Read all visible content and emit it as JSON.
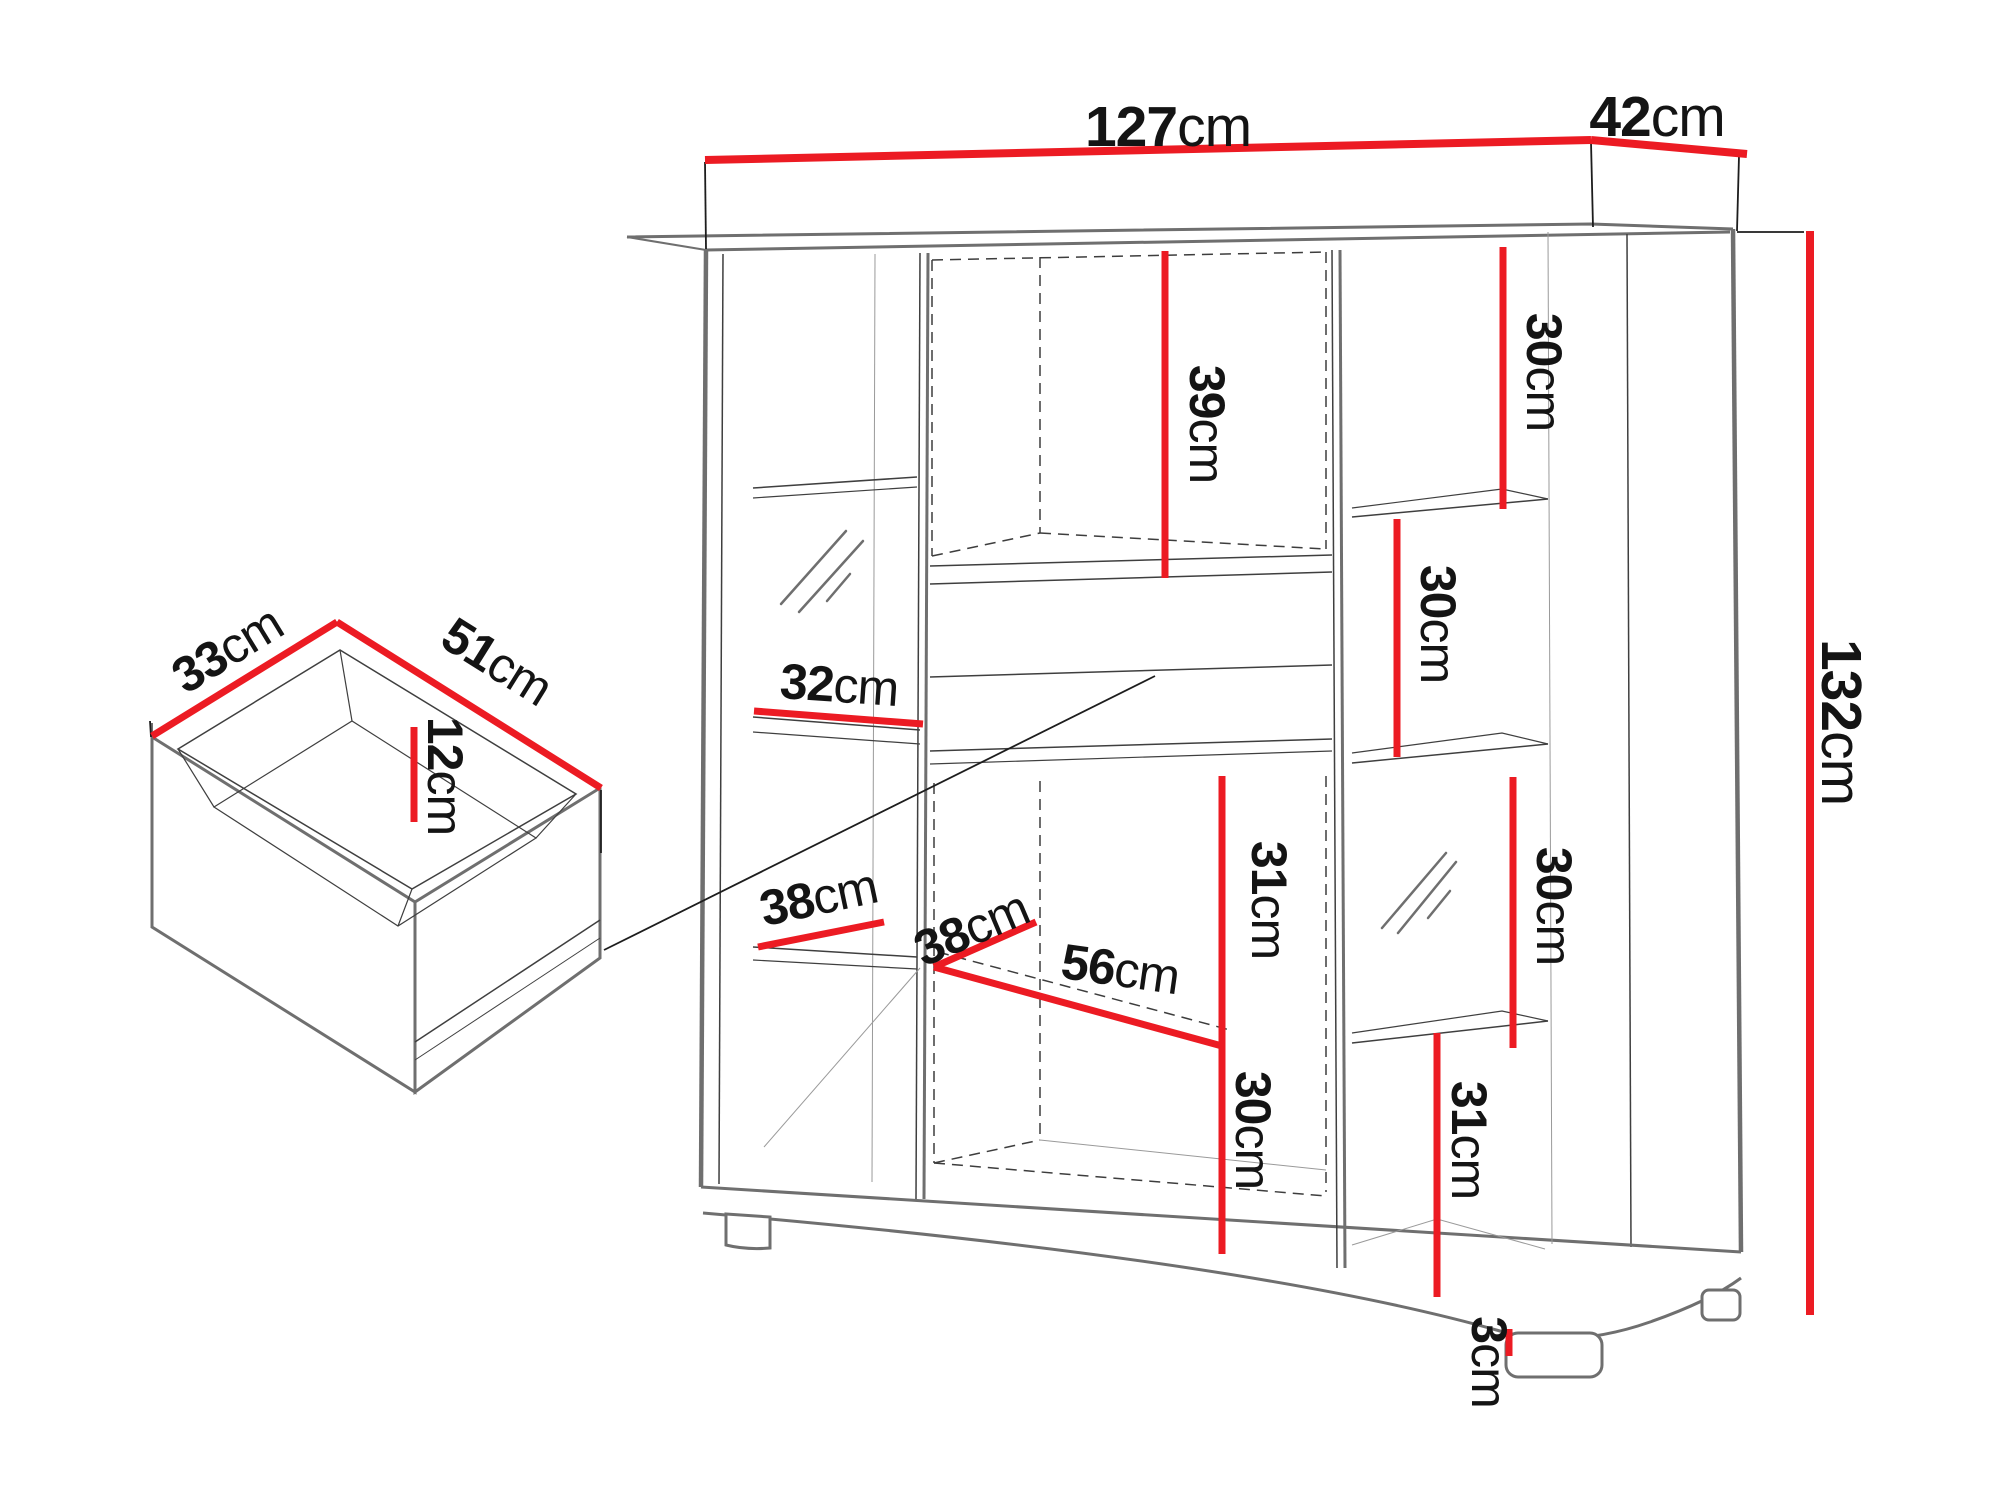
{
  "colors": {
    "dimension_red": "#ec1b23",
    "outline_gray": "#6f6f6f",
    "line_dark": "#3f3f3f",
    "background": "#ffffff"
  },
  "labels": {
    "width": {
      "value": "127",
      "unit": "cm"
    },
    "depth": {
      "value": "42",
      "unit": "cm"
    },
    "height": {
      "value": "132",
      "unit": "cm"
    },
    "niche_height": {
      "value": "39",
      "unit": "cm"
    },
    "right_top_cell": {
      "value": "30",
      "unit": "cm"
    },
    "right_middle_cell": {
      "value": "30",
      "unit": "cm"
    },
    "right_lower_cell": {
      "value": "30",
      "unit": "cm"
    },
    "left_shelf_width": {
      "value": "32",
      "unit": "cm"
    },
    "left_shelf_depth": {
      "value": "38",
      "unit": "cm"
    },
    "bottom_niche_depth": {
      "value": "38",
      "unit": "cm"
    },
    "bottom_niche_width": {
      "value": "56",
      "unit": "cm"
    },
    "center_cell_height": {
      "value": "31",
      "unit": "cm"
    },
    "bottom_cell_height": {
      "value": "30",
      "unit": "cm"
    },
    "right_bottom_cell": {
      "value": "31",
      "unit": "cm"
    },
    "foot_height": {
      "value": "3",
      "unit": "cm"
    },
    "drawer_depth": {
      "value": "33",
      "unit": "cm"
    },
    "drawer_width": {
      "value": "51",
      "unit": "cm"
    },
    "drawer_inner_height": {
      "value": "12",
      "unit": "cm"
    }
  }
}
